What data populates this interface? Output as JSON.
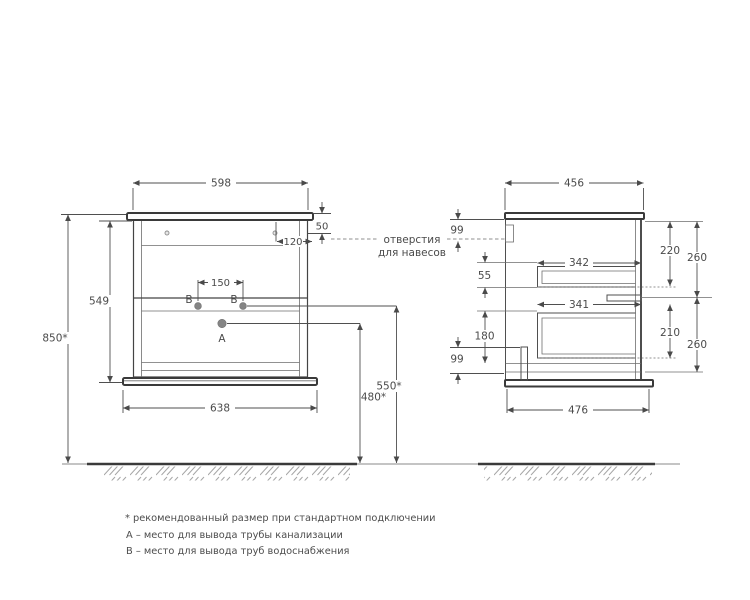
{
  "drawing": {
    "front": {
      "top_width": "598",
      "top_to_holes": "50",
      "hole_side_offset": "120",
      "carcass_height": "549",
      "total_height": "850*",
      "outlet_spacing": "150",
      "base_width": "638",
      "drain_outlet_height": "480*",
      "water_outlet_height": "550*",
      "point_a": "A",
      "point_b_left": "B",
      "point_b_right": "B"
    },
    "side": {
      "top_depth": "456",
      "hanger_top_offset": "99",
      "drawer_gap": "55",
      "drawer1_depth": "342",
      "drawer2_depth": "341",
      "drawer1_front_height": "220",
      "drawer1_total_height": "260",
      "drawer2_front_height": "210",
      "drawer2_total_height": "260",
      "back_panel_offset": "180",
      "bottom_offset": "99",
      "base_depth": "476"
    },
    "callout": {
      "line1": "отверстия",
      "line2": "для навесов"
    },
    "footnotes": [
      "* рекомендованный размер при стандартном подключении",
      "А – место для вывода трубы канализации",
      "В – место для вывода труб водоснабжения"
    ],
    "colors": {
      "line": "#4f4f4f",
      "outline": "#3a3a3a",
      "text": "#4a4a4a",
      "marker_dot": "#858585",
      "hatch": "#a6a6a6",
      "background": "#ffffff"
    }
  }
}
